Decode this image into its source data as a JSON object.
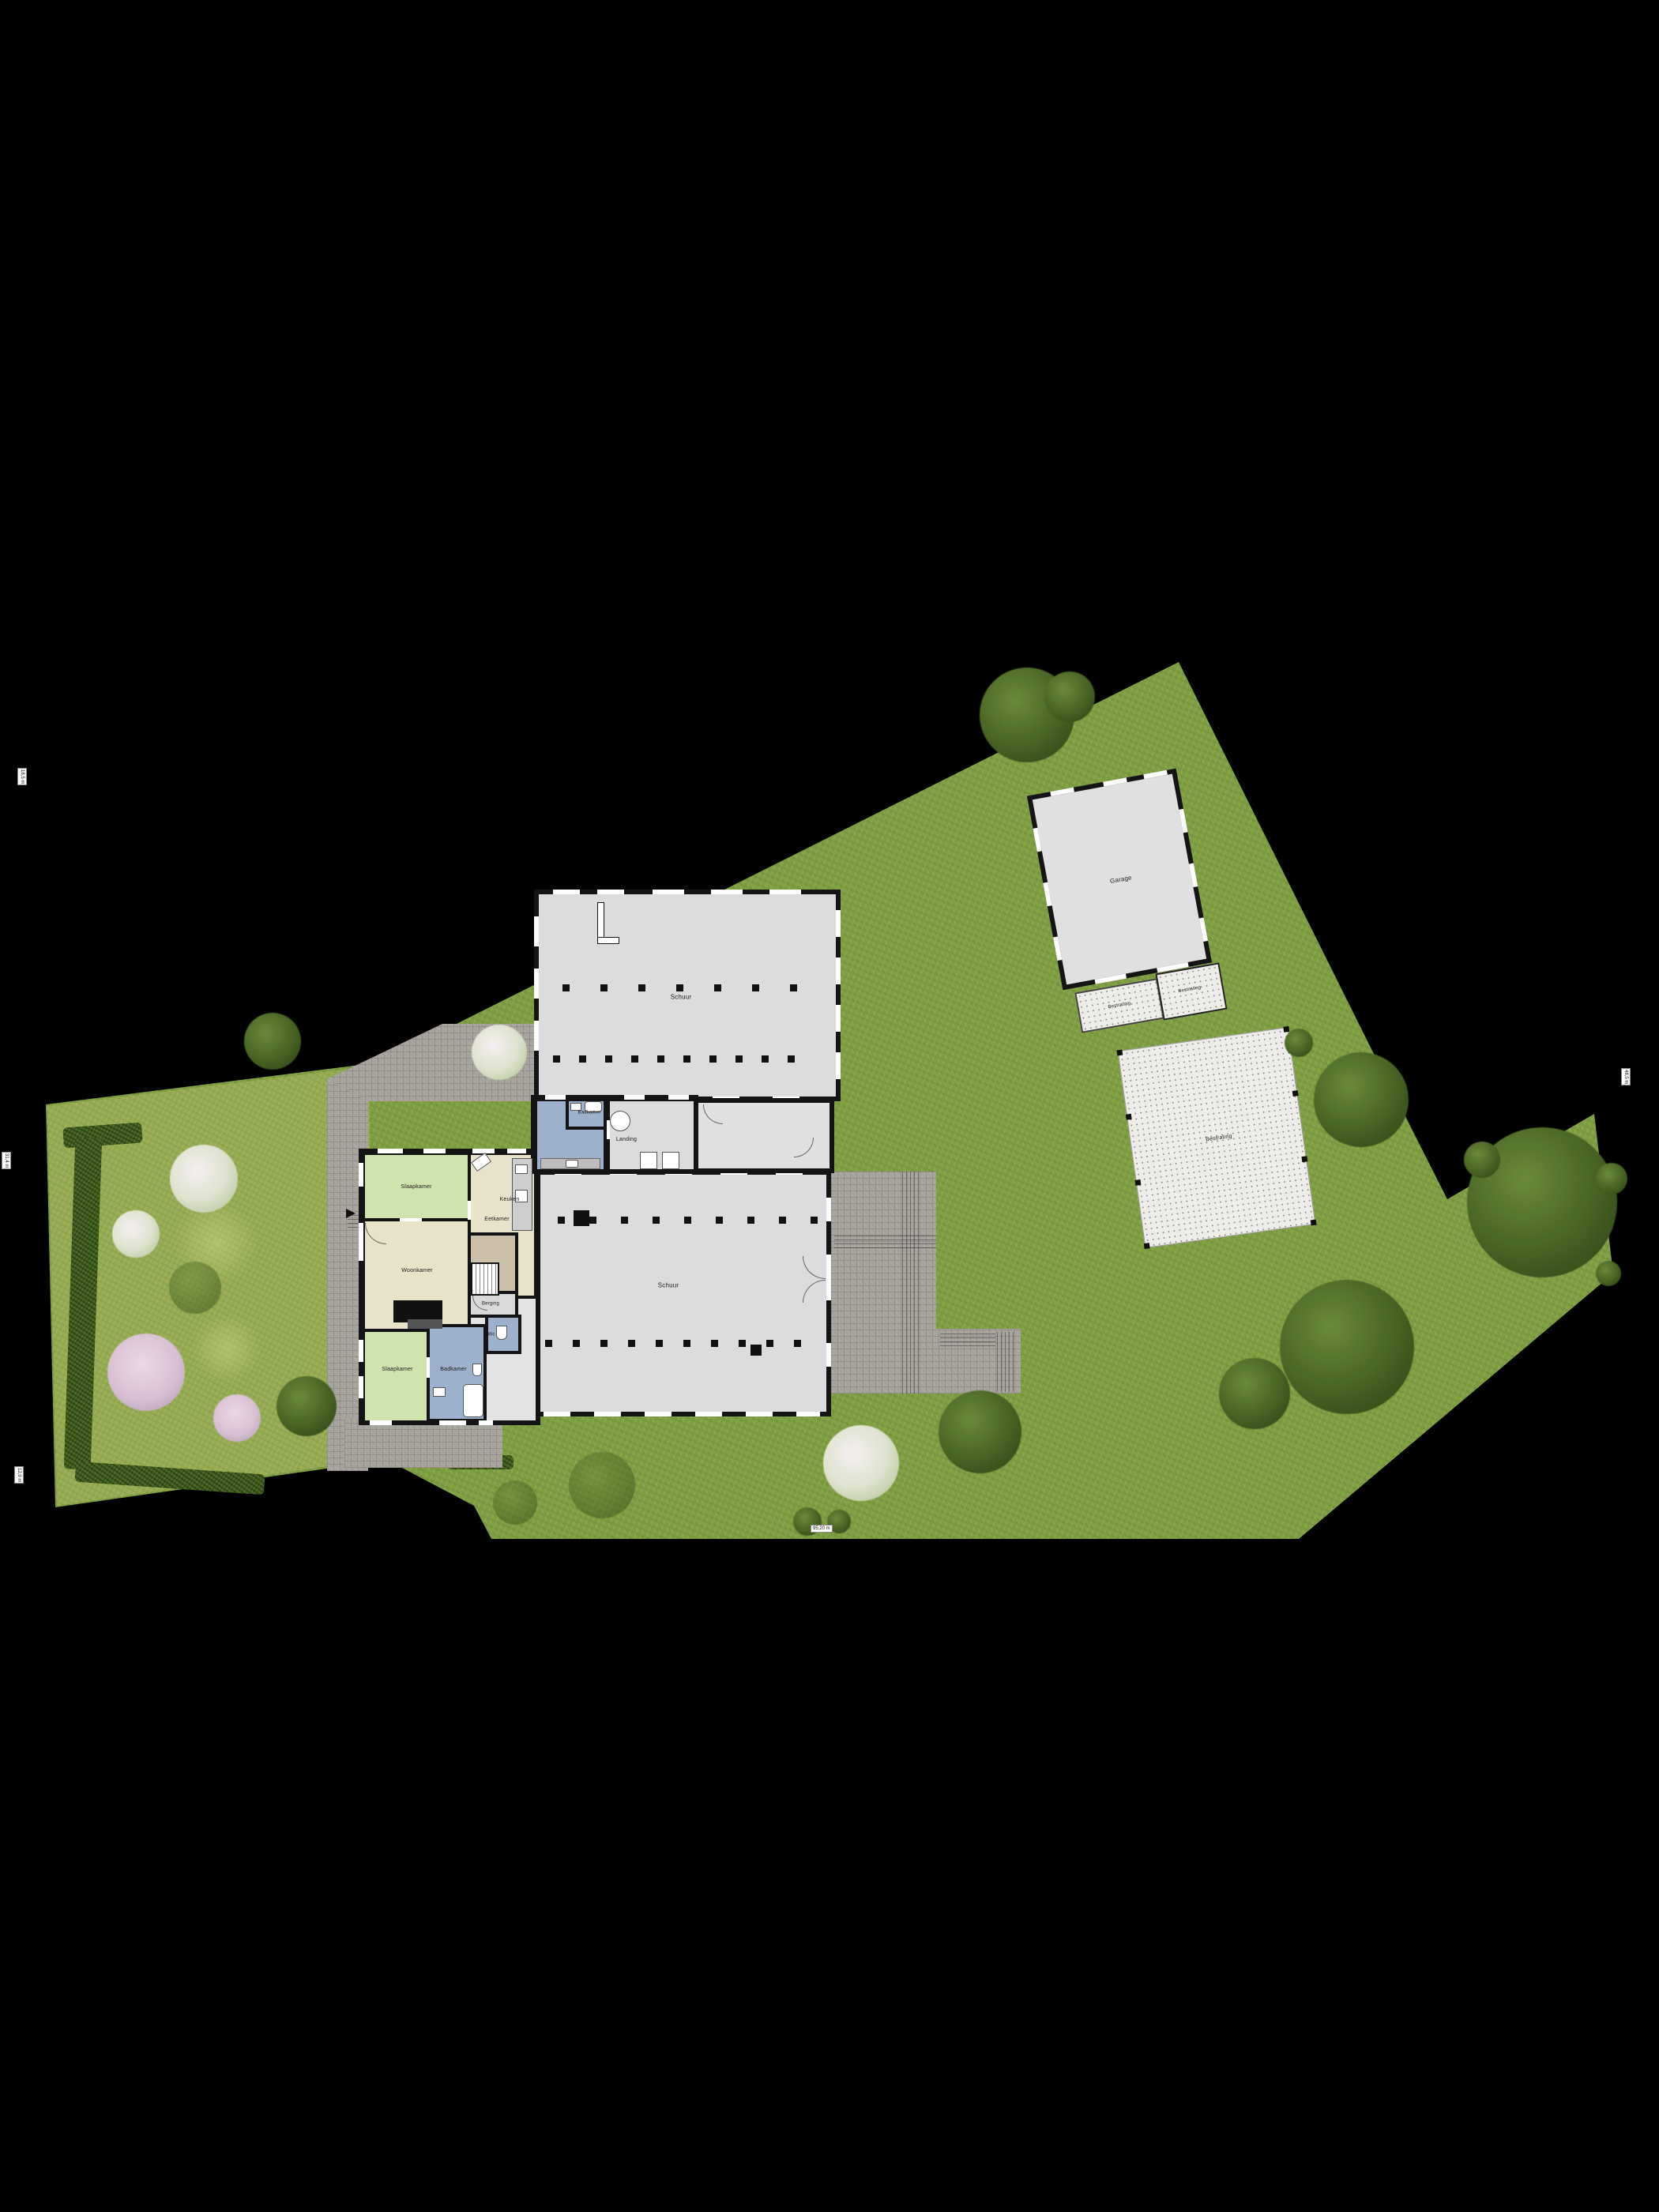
{
  "plan": {
    "type_label": "site-plan",
    "house": {
      "rooms": {
        "bedroom1": "Slaapkamer",
        "kitchen": "Keuken",
        "dining": "Eetkamer",
        "living": "Woonkamer",
        "bedroom2": "Slaapkamer",
        "bathroom": "Badkamer",
        "storage": "Berging",
        "wc": "Wc",
        "bathroom2": "Badkamer",
        "landing": "Landing"
      }
    },
    "barns": {
      "upper": "Schuur",
      "lower": "Schuur"
    },
    "garage": {
      "label": "Garage",
      "annex_left": "Bestrating",
      "annex_right": "Bestrating"
    },
    "paving": {
      "pad": "Bestrating"
    },
    "dimensions": {
      "left_top": "18,5 m",
      "left_mid": "31,4 m",
      "left_bottom": "12,9 m",
      "right": "48,5 m",
      "bottom": "95,20 m"
    },
    "colors": {
      "background": "#000000",
      "grass": "#7fa142",
      "lawn": "#95ab51",
      "hedge": "#3f5d1e",
      "wall": "#141414",
      "hall_fill": "#dcdcdc",
      "bedroom_fill": "#cfe3ad",
      "living_fill": "#e9e2ca",
      "wet_room_fill": "#9db1cc",
      "terrace": "#a6a29c",
      "concrete": "#eeedea"
    }
  }
}
